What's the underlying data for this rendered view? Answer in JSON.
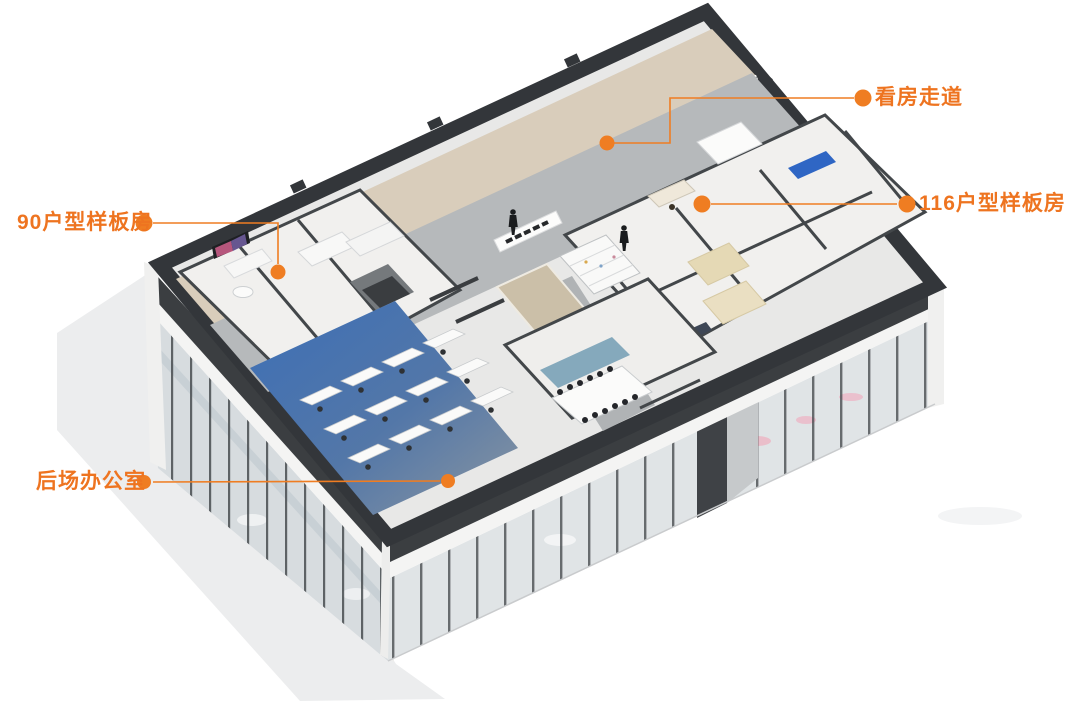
{
  "annotations": [
    {
      "label": "看房走道",
      "target": "viewing-corridor"
    },
    {
      "label": "116户型样板房",
      "target": "unit-116-model-room"
    },
    {
      "label": "90户型样板房",
      "target": "unit-90-model-room"
    },
    {
      "label": "后场办公室",
      "target": "back-office"
    }
  ],
  "colors": {
    "annotation_orange": "#EE7420",
    "parapet_dark": "#33363A",
    "floor_gray": "#B6B9BB",
    "wood_floor": "#D9CDBB",
    "office_carpet_blue": "#3D6FB6",
    "sofa_blue": "#2F66C4",
    "bed_beige": "#E5D9B5",
    "glass_facade": "#DCE0E3",
    "background": "#FFFFFF"
  }
}
